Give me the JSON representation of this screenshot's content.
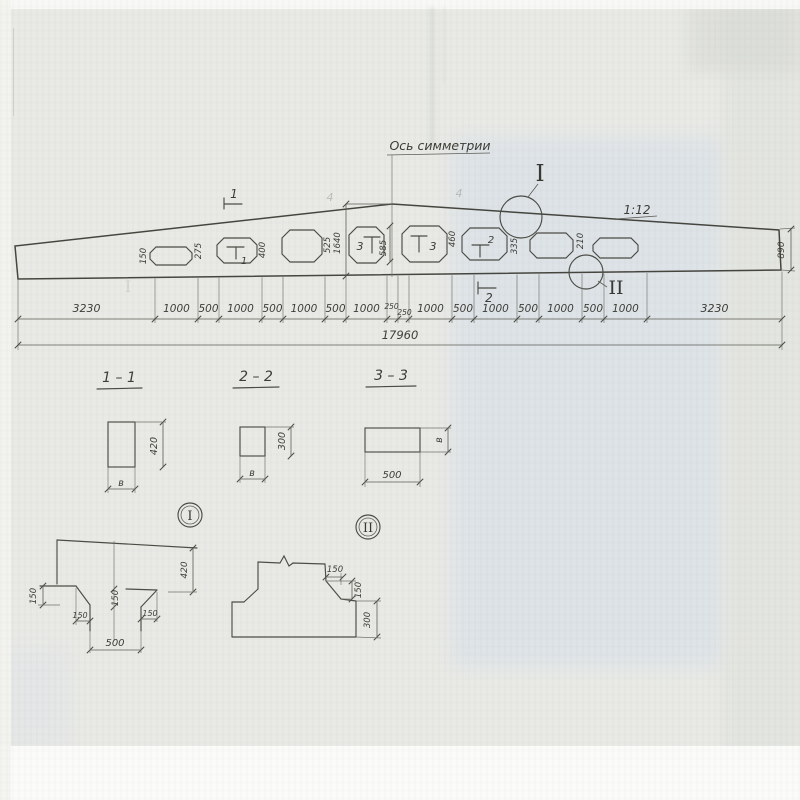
{
  "drawing": {
    "symmetry_axis_label": "Ось симметрии",
    "slope_label": "1:12",
    "total_length": "17960",
    "end_height_dim": "890",
    "chain_dims": [
      "3230",
      "1000",
      "500",
      "1000",
      "500",
      "1000",
      "500",
      "1000",
      "250",
      "250",
      "1000",
      "500",
      "1000",
      "500",
      "1000",
      "500",
      "1000",
      "3230"
    ],
    "neck_dims": [
      "150",
      "275",
      "400",
      "525",
      "1640",
      "585",
      "460",
      "335",
      "210"
    ],
    "cut_marks": {
      "above_beam": "1",
      "below_beam": "2",
      "in_hole_1": "1",
      "in_hole_2": "2",
      "in_hole_3_left": "3",
      "in_hole_3_right": "3"
    },
    "detail_circle_labels": {
      "d1": "I",
      "d2": "II"
    },
    "faint_marks": {
      "m1": "4",
      "m2": "4",
      "ghost": "I"
    }
  },
  "sections": [
    {
      "label": "1 – 1",
      "height_dim": "420",
      "width_dim": "в"
    },
    {
      "label": "2 – 2",
      "height_dim": "300",
      "width_dim": "в"
    },
    {
      "label": "3 – 3",
      "height_dim": "в",
      "width_dim": "500"
    }
  ],
  "details": [
    {
      "label": "I",
      "left_dim": "150",
      "mid_dim": "150",
      "chamfer_left_dim": "150",
      "chamfer_right_dim": "150",
      "bottom_dim": "500",
      "height_dim": "420"
    },
    {
      "label": "II",
      "top_dim": "150",
      "side_dim": "150",
      "height_dim": "300"
    }
  ]
}
